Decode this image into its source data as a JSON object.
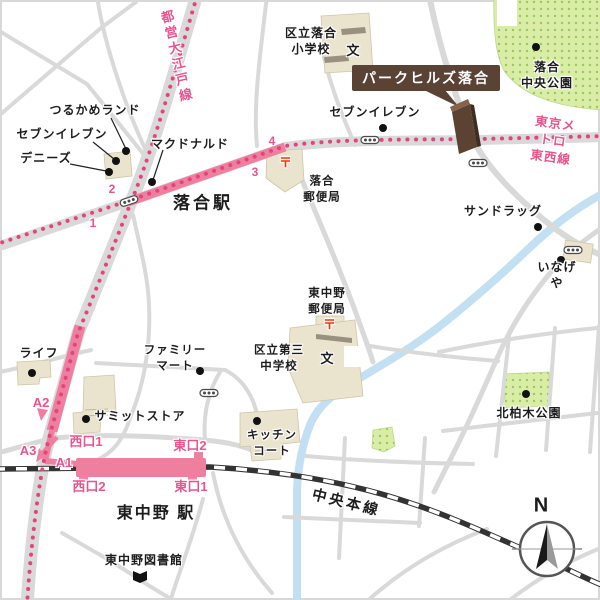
{
  "lines": {
    "oedo": "都営大江戸線",
    "tozai": "東京メトロ\n東西線",
    "chuo": "中央本線"
  },
  "stations": {
    "ochiai": "落合駅",
    "higashinakano": "東中野 駅"
  },
  "exits": {
    "n1": "1",
    "n2": "2",
    "n3": "3",
    "n4": "4",
    "a1": "A1",
    "a2": "A2",
    "a3": "A3",
    "west1": "西口1",
    "west2": "西口2",
    "east1": "東口1",
    "east2": "東口2"
  },
  "property": {
    "name": "パークヒルズ落合"
  },
  "pois": {
    "tsurukame": "つるかめランド",
    "seven_eleven_west": "セブンイレブン",
    "dennys": "デニーズ",
    "mcdonalds": "マクドナルド",
    "seven_eleven_center": "セブンイレブン",
    "ochiai_elementary": "区立落合\n小学校",
    "ochiai_post_office": "落合\n郵便局",
    "ochiai_central_park": "落合\n中央公園",
    "sundrug": "サンドラッグ",
    "inageya": "いなげや",
    "higashinakano_post_office": "東中野\n郵便局",
    "daisan_junior_high": "区立第三\n中学校",
    "familymart": "ファミリー\nマート",
    "summit_store": "サミットストア",
    "life": "ライフ",
    "kitchen_court": "キッチン\nコート",
    "kitakashiwagi_park": "北柏木公園",
    "higashinakano_library": "東中野図書館"
  },
  "symbols": {
    "school": "文",
    "post": "〒",
    "north": "N"
  },
  "colors": {
    "route_pink": "#ee7f9e",
    "dotted_line_pink": "#e2457d",
    "exit_label_pink": "#e7548f",
    "park_green": "#d9eda7",
    "building_beige": "#eae3cd",
    "property_brown": "#5a4334",
    "post_red": "#e8380c",
    "road_grey": "#d9d9d9",
    "river_blue": "#c3e0f2"
  }
}
